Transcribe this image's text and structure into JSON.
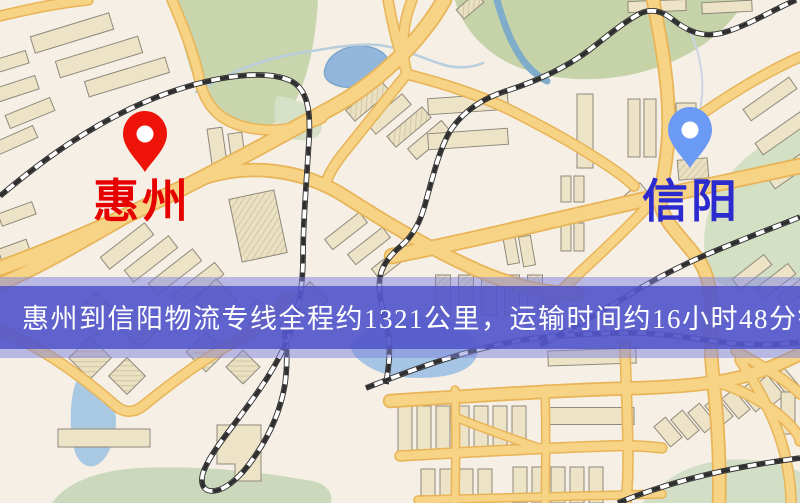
{
  "map": {
    "origin": {
      "label": "惠州",
      "pin_color": "#ee1409",
      "label_color": "#e60000"
    },
    "destination": {
      "label": "信阳",
      "pin_color": "#6b9af4",
      "label_color": "#2b2bd0"
    },
    "banner": {
      "text": "惠州到信阳物流专线全程约1321公里，运输时间约16小时48分钟.",
      "text_color": "#ffffff",
      "bg_color": "#4f52c8",
      "halo_color": "#7e82dd"
    },
    "legend": {
      "road_color": "#f7d385",
      "railway_color": "#2f2f2f",
      "park_color": "#c6d2a8",
      "water_color": "#a6c4e4"
    }
  }
}
